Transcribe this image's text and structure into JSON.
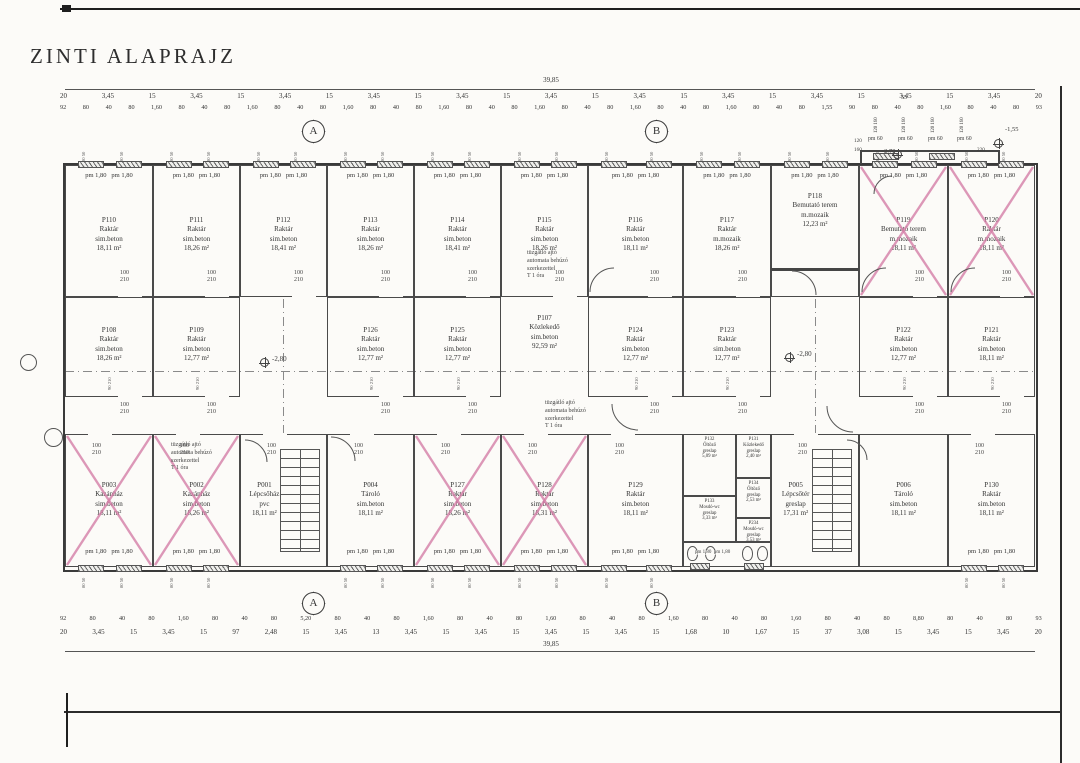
{
  "title": "ZINTI ALAPRAJZ",
  "colors": {
    "paper": "#fcfbf8",
    "ink": "#3a3a3a",
    "cross": "#d57fa8"
  },
  "window_label": "pm 1,80   pm 1,80",
  "door_label": [
    "100",
    "210"
  ],
  "wall_tick": "80 50",
  "mid_tick": "90 210",
  "fire_note": {
    "lines": [
      "tüzgátló ajtó",
      "automata behúzó",
      "szerkezettel",
      "T 1 óra"
    ],
    "positions": [
      {
        "x": 527,
        "y": 250
      },
      {
        "x": 545,
        "y": 400
      },
      {
        "x": 171,
        "y": 442
      }
    ]
  },
  "corridor": {
    "id": "P107",
    "name": "Közlekedő",
    "floor": "sim.beton",
    "area": "92,59 m²",
    "x": 501,
    "y": 314,
    "w": 87
  },
  "rooms": [
    {
      "id": "P110",
      "name": "Raktár",
      "floor": "sim.beton",
      "area": "18,11 m²",
      "x": 65,
      "y": 165,
      "w": 88,
      "h": 132,
      "row": "top",
      "win": "top",
      "door": "bottom"
    },
    {
      "id": "P111",
      "name": "Raktár",
      "floor": "sim.beton",
      "area": "18,26 m²",
      "x": 153,
      "y": 165,
      "w": 87,
      "h": 132,
      "row": "top",
      "win": "top",
      "door": "bottom"
    },
    {
      "id": "P112",
      "name": "Raktár",
      "floor": "sim.beton",
      "area": "18,41 m²",
      "x": 240,
      "y": 165,
      "w": 87,
      "h": 132,
      "row": "top",
      "win": "top",
      "door": "bottom"
    },
    {
      "id": "P113",
      "name": "Raktár",
      "floor": "sim.beton",
      "area": "18,26 m²",
      "x": 327,
      "y": 165,
      "w": 87,
      "h": 132,
      "row": "top",
      "win": "top",
      "door": "bottom"
    },
    {
      "id": "P114",
      "name": "Raktár",
      "floor": "sim.beton",
      "area": "18,41 m²",
      "x": 414,
      "y": 165,
      "w": 87,
      "h": 132,
      "row": "top",
      "win": "top",
      "door": "bottom"
    },
    {
      "id": "P115",
      "name": "Raktár",
      "floor": "sim.beton",
      "area": "18,26 m²",
      "x": 501,
      "y": 165,
      "w": 87,
      "h": 132,
      "row": "top",
      "win": "top",
      "door": "bottom"
    },
    {
      "id": "P116",
      "name": "Raktár",
      "floor": "sim.beton",
      "area": "18,11 m²",
      "x": 588,
      "y": 165,
      "w": 95,
      "h": 132,
      "row": "top",
      "win": "top",
      "door": "bottom"
    },
    {
      "id": "P117",
      "name": "Raktár",
      "floor": "m.mozaik",
      "area": "18,26 m²",
      "x": 683,
      "y": 165,
      "w": 88,
      "h": 132,
      "row": "top",
      "win": "top",
      "door": "bottom"
    },
    {
      "id": "P118",
      "name": "Bemutató terem",
      "floor": "m.mozaik",
      "area": "12,23 m²",
      "x": 771,
      "y": 165,
      "w": 88,
      "h": 132,
      "row": "top",
      "win": "top",
      "lt": 26
    },
    {
      "id": "P119",
      "name": "Bemutató terem",
      "floor": "m.mozaik",
      "area": "18,11 m²",
      "x": 859,
      "y": 165,
      "w": 89,
      "h": 132,
      "row": "top",
      "win": "top",
      "door": "bottom",
      "cross": true
    },
    {
      "id": "P120",
      "name": "Raktár",
      "floor": "m.mozaik",
      "area": "18,11 m²",
      "x": 948,
      "y": 165,
      "w": 87,
      "h": 132,
      "row": "top",
      "win": "top",
      "door": "bottom",
      "cross": true
    },
    {
      "id": "P108",
      "name": "Raktár",
      "floor": "sim.beton",
      "area": "18,26 m²",
      "x": 65,
      "y": 297,
      "w": 88,
      "h": 100,
      "row": "mid",
      "door": "bottom"
    },
    {
      "id": "P109",
      "name": "Raktár",
      "floor": "sim.beton",
      "area": "12,77 m²",
      "x": 153,
      "y": 297,
      "w": 87,
      "h": 100,
      "row": "mid",
      "door": "bottom"
    },
    {
      "id": "P126",
      "name": "Raktár",
      "floor": "sim.beton",
      "area": "12,77 m²",
      "x": 327,
      "y": 297,
      "w": 87,
      "h": 100,
      "row": "mid",
      "door": "bottom"
    },
    {
      "id": "P125",
      "name": "Raktár",
      "floor": "sim.beton",
      "area": "12,77 m²",
      "x": 414,
      "y": 297,
      "w": 87,
      "h": 100,
      "row": "mid",
      "door": "bottom"
    },
    {
      "id": "P124",
      "name": "Raktár",
      "floor": "sim.beton",
      "area": "12,77 m²",
      "x": 588,
      "y": 297,
      "w": 95,
      "h": 100,
      "row": "mid",
      "door": "bottom"
    },
    {
      "id": "P123",
      "name": "Raktár",
      "floor": "sim.beton",
      "area": "12,77 m²",
      "x": 683,
      "y": 297,
      "w": 88,
      "h": 100,
      "row": "mid",
      "door": "bottom"
    },
    {
      "id": "P122",
      "name": "Raktár",
      "floor": "sim.beton",
      "area": "12,77 m²",
      "x": 859,
      "y": 297,
      "w": 89,
      "h": 100,
      "row": "mid",
      "door": "bottom"
    },
    {
      "id": "P121",
      "name": "Raktár",
      "floor": "sim.beton",
      "area": "18,11 m²",
      "x": 948,
      "y": 297,
      "w": 87,
      "h": 100,
      "row": "mid",
      "door": "bottom"
    },
    {
      "id": "P003",
      "name": "Kazánház",
      "floor": "sim.beton",
      "area": "18,11 m²",
      "x": 65,
      "y": 434,
      "w": 88,
      "h": 133,
      "row": "bottom",
      "win": "bottom",
      "door": "top",
      "cross": true
    },
    {
      "id": "P002",
      "name": "Kazánház",
      "floor": "sim.beton",
      "area": "18,26 m²",
      "x": 153,
      "y": 434,
      "w": 87,
      "h": 133,
      "row": "bottom",
      "win": "bottom",
      "door": "top",
      "cross": true
    },
    {
      "id": "P001",
      "name": "Lépcsőház",
      "floor": "pvc",
      "area": "18,11 m²",
      "x": 240,
      "y": 434,
      "w": 87,
      "h": 133,
      "row": "bottom",
      "door": "top",
      "stairs": true
    },
    {
      "id": "P004",
      "name": "Tároló",
      "floor": "sim.beton",
      "area": "18,11 m²",
      "x": 327,
      "y": 434,
      "w": 87,
      "h": 133,
      "row": "bottom",
      "win": "bottom",
      "door": "top"
    },
    {
      "id": "P127",
      "name": "Raktár",
      "floor": "sim.beton",
      "area": "18,26 m²",
      "x": 414,
      "y": 434,
      "w": 87,
      "h": 133,
      "row": "bottom",
      "win": "bottom",
      "door": "top",
      "cross": true
    },
    {
      "id": "P128",
      "name": "Raktár",
      "floor": "sim.beton",
      "area": "18,31 m²",
      "x": 501,
      "y": 434,
      "w": 87,
      "h": 133,
      "row": "bottom",
      "win": "bottom",
      "door": "top",
      "cross": true
    },
    {
      "id": "P129",
      "name": "Raktár",
      "floor": "sim.beton",
      "area": "18,11 m²",
      "x": 588,
      "y": 434,
      "w": 95,
      "h": 133,
      "row": "bottom",
      "win": "bottom",
      "door": "top"
    },
    {
      "id": "P132",
      "name": "Öltöző",
      "floor": "greslap",
      "area": "5,09 m²",
      "x": 683,
      "y": 434,
      "w": 53,
      "h": 62,
      "small": true
    },
    {
      "id": "P131",
      "name": "Közlekedő",
      "floor": "greslap",
      "area": "2,40 m²",
      "x": 736,
      "y": 434,
      "w": 35,
      "h": 44,
      "small": true
    },
    {
      "id": "P134",
      "name": "Öltöző",
      "floor": "greslap",
      "area": "2,53 m²",
      "x": 736,
      "y": 478,
      "w": 35,
      "h": 40,
      "small": true
    },
    {
      "id": "P133",
      "name": "Mosdó-wc",
      "floor": "greslap",
      "area": "3,33 m²",
      "x": 683,
      "y": 496,
      "w": 53,
      "h": 46,
      "small": true
    },
    {
      "id": "P234",
      "name": "Mosdó-wc",
      "floor": "greslap",
      "area": "3,53 m²",
      "x": 736,
      "y": 518,
      "w": 35,
      "h": 24,
      "small": true
    },
    {
      "id": "P005",
      "name": "Lépcsőtér",
      "floor": "greslap",
      "area": "17,31 m²",
      "x": 771,
      "y": 434,
      "w": 88,
      "h": 133,
      "row": "bottom",
      "door": "top",
      "stairs": true
    },
    {
      "id": "P006",
      "name": "Tároló",
      "floor": "sim.beton",
      "area": "18,11 m²",
      "x": 859,
      "y": 434,
      "w": 89,
      "h": 133,
      "row": "bottom"
    },
    {
      "id": "P130",
      "name": "Raktár",
      "floor": "sim.beton",
      "area": "18,11 m²",
      "x": 948,
      "y": 434,
      "w": 87,
      "h": 133,
      "row": "bottom",
      "win": "bottom",
      "door": "top"
    }
  ],
  "toilet_band": {
    "x": 683,
    "y": 542,
    "w": 88,
    "h": 25,
    "toilets": [
      687,
      705,
      742,
      757
    ],
    "label": "pm 1,80  pm 1,80"
  },
  "levels_and_texts": [
    {
      "t": "-2,80",
      "x": 272,
      "y": 355,
      "s": 7
    },
    {
      "t": "-2,80",
      "x": 797,
      "y": 350,
      "s": 7
    },
    {
      "t": "-2,70",
      "x": 882,
      "y": 148,
      "s": 6.5
    },
    {
      "t": "-1,55",
      "x": 1005,
      "y": 126,
      "s": 6.5
    },
    {
      "t": "pm 60",
      "x": 868,
      "y": 136,
      "s": 5.8
    },
    {
      "t": "pm 60",
      "x": 898,
      "y": 136,
      "s": 5.8
    },
    {
      "t": "pm 60",
      "x": 928,
      "y": 136,
      "s": 5.8
    },
    {
      "t": "pm 60",
      "x": 957,
      "y": 136,
      "s": 5.8
    },
    {
      "t": "120",
      "x": 854,
      "y": 138,
      "s": 5.2
    },
    {
      "t": "160",
      "x": 854,
      "y": 147,
      "s": 5.2
    },
    {
      "t": "220",
      "x": 977,
      "y": 147,
      "s": 5.2
    },
    {
      "t": "55",
      "x": 901,
      "y": 95,
      "s": 6
    },
    {
      "t": "120 160",
      "x": 874,
      "y": 133,
      "s": 4.8,
      "r": -90
    },
    {
      "t": "120 160",
      "x": 902,
      "y": 133,
      "s": 4.8,
      "r": -90
    },
    {
      "t": "120 160",
      "x": 931,
      "y": 133,
      "s": 4.8,
      "r": -90
    },
    {
      "t": "120 160",
      "x": 960,
      "y": 133,
      "s": 4.8,
      "r": -90
    }
  ],
  "benchmarks": [
    {
      "x": 260,
      "y": 358
    },
    {
      "x": 785,
      "y": 353
    },
    {
      "x": 994,
      "y": 139
    },
    {
      "x": 893,
      "y": 150
    }
  ],
  "axis_markers": [
    {
      "label": "A",
      "x": 300,
      "y": 118
    },
    {
      "label": "B",
      "x": 643,
      "y": 118
    },
    {
      "label": "A",
      "x": 300,
      "y": 590
    },
    {
      "label": "B",
      "x": 643,
      "y": 590
    }
  ],
  "left_markers": [
    {
      "x": 20,
      "y": 354,
      "w": 17,
      "h": 17
    },
    {
      "x": 44,
      "y": 428,
      "w": 19,
      "h": 19
    }
  ],
  "dashes": [
    {
      "x": 65,
      "y": 371,
      "w": 970,
      "h": 1
    },
    {
      "x": 283,
      "y": 299,
      "w": 1,
      "h": 134
    },
    {
      "x": 815,
      "y": 299,
      "w": 1,
      "h": 134
    }
  ],
  "walls": [
    {
      "x": 771,
      "y": 268,
      "w": 88,
      "h": 3
    },
    {
      "x": 860,
      "y": 150,
      "w": 140,
      "h": 2
    },
    {
      "x": 860,
      "y": 150,
      "w": 2,
      "h": 14
    },
    {
      "x": 998,
      "y": 150,
      "w": 2,
      "h": 14
    }
  ],
  "extra_windows": [
    {
      "x": 873,
      "y": 153,
      "w": 26
    },
    {
      "x": 929,
      "y": 153,
      "w": 26
    },
    {
      "x": 690,
      "y": 563,
      "w": 20
    },
    {
      "x": 744,
      "y": 563,
      "w": 20
    }
  ],
  "arcs": [
    {
      "x": 590,
      "y": 268,
      "r": 24,
      "rot": 0
    },
    {
      "x": 816,
      "y": 271,
      "r": 24,
      "rot": 90
    },
    {
      "x": 862,
      "y": 268,
      "r": 24,
      "rot": 0
    },
    {
      "x": 951,
      "y": 268,
      "r": 24,
      "rot": 0
    },
    {
      "x": 355,
      "y": 437,
      "r": 24,
      "rot": 90
    },
    {
      "x": 267,
      "y": 440,
      "r": 22,
      "rot": 90
    },
    {
      "x": 612,
      "y": 430,
      "r": 26,
      "rot": 270
    },
    {
      "x": 827,
      "y": 432,
      "r": 26,
      "rot": 270
    },
    {
      "x": 867,
      "y": 440,
      "r": 20,
      "rot": 90
    },
    {
      "x": 874,
      "y": 176,
      "r": 18,
      "rot": 0
    }
  ],
  "dims_top": {
    "total": "39,85",
    "m": [
      "20",
      "3,45",
      "15",
      "3,45",
      "15",
      "3,45",
      "15",
      "3,45",
      "15",
      "3,45",
      "15",
      "3,45",
      "15",
      "3,45",
      "15",
      "3,45",
      "15",
      "3,45",
      "15",
      "3,45",
      "15",
      "3,45",
      "20"
    ],
    "cm": [
      "92",
      "80",
      "40",
      "80",
      "1,60",
      "80",
      "40",
      "80",
      "1,60",
      "80",
      "40",
      "80",
      "1,60",
      "80",
      "40",
      "80",
      "1,60",
      "80",
      "40",
      "80",
      "1,60",
      "80",
      "40",
      "80",
      "1,60",
      "80",
      "40",
      "80",
      "1,60",
      "80",
      "40",
      "80",
      "1,55",
      "90",
      "80",
      "40",
      "80",
      "1,60",
      "80",
      "40",
      "80",
      "93"
    ]
  },
  "dims_bottom": {
    "total": "39,85",
    "cm": [
      "92",
      "80",
      "40",
      "80",
      "1,60",
      "80",
      "40",
      "80",
      "5,20",
      "80",
      "40",
      "80",
      "1,60",
      "80",
      "40",
      "80",
      "1,60",
      "80",
      "40",
      "80",
      "1,60",
      "80",
      "40",
      "80",
      "1,60",
      "80",
      "40",
      "80",
      "8,80",
      "80",
      "40",
      "80",
      "93"
    ],
    "m": [
      "20",
      "3,45",
      "15",
      "3,45",
      "15",
      "97",
      "2,48",
      "15",
      "3,45",
      "13",
      "3,45",
      "15",
      "3,45",
      "15",
      "3,45",
      "15",
      "3,45",
      "15",
      "1,68",
      "10",
      "1,67",
      "15",
      "37",
      "3,08",
      "15",
      "3,45",
      "15",
      "3,45",
      "20"
    ]
  }
}
